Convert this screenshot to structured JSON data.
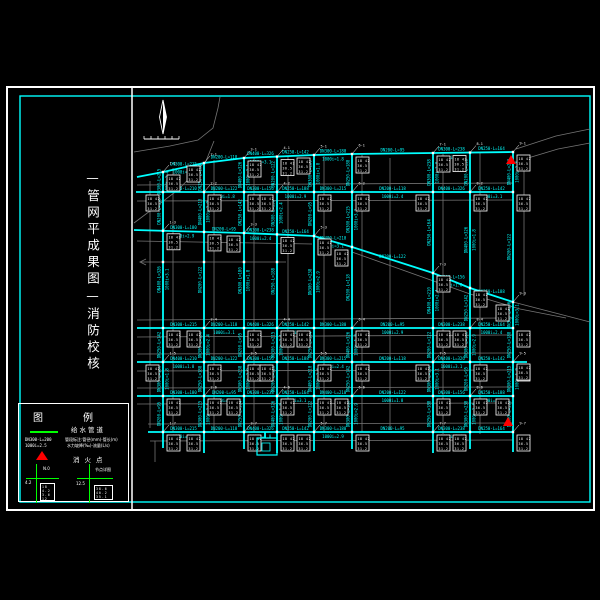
{
  "colors": {
    "background": "#000000",
    "frame": "#ffffff",
    "inner_frame": "#00ffff",
    "pipe": "#00ffff",
    "road": "#757575",
    "pipe_label": "#00ffff",
    "node_label": "#ffffff",
    "legend_green": "#00ff00",
    "hydrant_red": "#ff0000"
  },
  "frame": {
    "outer": [
      7,
      87,
      587,
      423
    ],
    "inner": [
      20,
      96,
      570,
      406
    ],
    "divider_x": 132
  },
  "title_block": {
    "vertical_title": "—管网平成果图—消防校核"
  },
  "legend": {
    "title": "图例",
    "pipe_label": "给水管道",
    "pipe_sym_line1": "DN300-L=200",
    "pipe_sym_line2": "1000i=2.5",
    "pipe_note_line1": "管段标注:管径(mm)-管长(m)",
    "pipe_note_line2": "水力坡降(‰)-流量(L/s)",
    "hydrant_label": "消火点",
    "node_left_label": "N.0",
    "node_left_sub": "4.2",
    "node_right_label": "节点详图",
    "node_right_sub": "12.5",
    "legend_table_left": [
      "18",
      "4.2",
      "3.6",
      "12"
    ],
    "legend_table_right": [
      "38.6",
      "40.2",
      "35.1"
    ]
  },
  "network": {
    "columns": [
      163,
      204,
      244,
      277,
      314,
      352,
      433,
      470,
      513
    ],
    "col_top_y": [
      172,
      163,
      158,
      156,
      155,
      154,
      153,
      152,
      152
    ],
    "col_bottom_y": [
      448,
      453,
      449,
      453,
      451,
      449,
      453,
      449,
      452
    ],
    "flat_rows": [
      [
        136,
        192,
        513,
        192
      ],
      [
        137,
        328,
        513,
        328
      ],
      [
        137,
        362,
        527,
        362
      ],
      [
        137,
        396,
        513,
        396
      ],
      [
        148,
        432,
        513,
        432
      ]
    ],
    "top_row": [
      [
        137,
        177
      ],
      [
        163,
        172
      ],
      [
        204,
        163
      ],
      [
        244,
        158
      ],
      [
        314,
        155
      ],
      [
        352,
        154
      ],
      [
        433,
        153
      ],
      [
        513,
        152
      ]
    ],
    "mid_row": [
      [
        134,
        230
      ],
      [
        244,
        233
      ],
      [
        314,
        236
      ],
      [
        352,
        247
      ],
      [
        433,
        273
      ],
      [
        470,
        288
      ],
      [
        513,
        302
      ]
    ],
    "roads": [
      [
        [
          134,
          152
        ],
        [
          170,
          146
        ],
        [
          198,
          140
        ],
        [
          213,
          128
        ],
        [
          218,
          108
        ],
        [
          220,
          97
        ]
      ],
      [
        [
          134,
          223
        ],
        [
          178,
          190
        ],
        [
          206,
          161
        ],
        [
          214,
          141
        ]
      ],
      [
        [
          140,
          262
        ],
        [
          286,
          262
        ]
      ],
      [
        [
          146,
          259
        ],
        [
          140,
          262
        ],
        [
          146,
          265
        ]
      ],
      [
        [
          150,
          181
        ],
        [
          150,
          428
        ]
      ],
      [
        [
          173,
          168
        ],
        [
          173,
          432
        ]
      ],
      [
        [
          214,
          160
        ],
        [
          214,
          432
        ]
      ],
      [
        [
          254,
          158
        ],
        [
          254,
          432
        ]
      ],
      [
        [
          288,
          157
        ],
        [
          288,
          432
        ]
      ],
      [
        [
          324,
          156
        ],
        [
          324,
          432
        ]
      ],
      [
        [
          362,
          155
        ],
        [
          362,
          432
        ]
      ],
      [
        [
          390,
          158
        ],
        [
          390,
          430
        ]
      ],
      [
        [
          443,
          154
        ],
        [
          443,
          434
        ]
      ],
      [
        [
          480,
          153
        ],
        [
          480,
          434
        ]
      ],
      [
        [
          524,
          158
        ],
        [
          524,
          296
        ]
      ],
      [
        [
          137,
          185
        ],
        [
          513,
          183
        ]
      ],
      [
        [
          137,
          201
        ],
        [
          513,
          200
        ]
      ],
      [
        [
          137,
          241
        ],
        [
          312,
          244
        ]
      ],
      [
        [
          137,
          320
        ],
        [
          513,
          318
        ]
      ],
      [
        [
          137,
          337
        ],
        [
          513,
          335
        ]
      ],
      [
        [
          137,
          354
        ],
        [
          513,
          353
        ]
      ],
      [
        [
          137,
          371
        ],
        [
          513,
          370
        ]
      ],
      [
        [
          137,
          388
        ],
        [
          513,
          387
        ]
      ],
      [
        [
          137,
          404
        ],
        [
          513,
          403
        ]
      ],
      [
        [
          148,
          424
        ],
        [
          513,
          423
        ]
      ],
      [
        [
          150,
          441
        ],
        [
          513,
          440
        ]
      ],
      [
        [
          155,
          441
        ],
        [
          155,
          462
        ]
      ],
      [
        [
          513,
          302
        ],
        [
          590,
          322
        ]
      ],
      [
        [
          352,
          252
        ],
        [
          470,
          294
        ],
        [
          520,
          309
        ],
        [
          566,
          318
        ]
      ],
      [
        [
          516,
          149
        ],
        [
          556,
          136
        ],
        [
          590,
          129
        ]
      ],
      [
        [
          518,
          161
        ],
        [
          558,
          149
        ],
        [
          590,
          143
        ]
      ]
    ],
    "road_cross_nodes": [
      [
        163,
        262
      ],
      [
        204,
        262
      ],
      [
        244,
        262
      ],
      [
        277,
        262
      ]
    ],
    "hydrants": [
      [
        511,
        161
      ],
      [
        508,
        423
      ]
    ],
    "special_box": [
      257,
      438,
      20,
      17
    ],
    "special_box_inner": [
      262,
      443,
      8,
      8
    ],
    "special_box_stub": [
      265,
      432,
      265,
      438
    ],
    "extra_boxes": [
      [
        517,
        364
      ]
    ],
    "compass": {
      "x": 163,
      "y1": 100,
      "y2": 134
    },
    "scalebar": {
      "x1": 144,
      "x2": 179,
      "y": 139,
      "ticks": 6
    },
    "label_pool": [
      "DN300-L=215",
      "DN200-L=118",
      "DN400-L=326",
      "DN250-L=142",
      "DN300-L=180",
      "DN200-L=95",
      "DN300-L=238",
      "DN250-L=164",
      "DN400-L=210",
      "DN200-L=122",
      "DN300-L=156",
      "DN250-L=188"
    ],
    "sub_pool": [
      "1000i=2.4",
      "q=36.5",
      "1000i=3.1",
      "q=18.2",
      "1000i=1.8",
      "q=42.0",
      "1000i=2.9",
      "q=25.4"
    ],
    "node_box_rows": [
      "18 42",
      "36.5",
      "31.2"
    ]
  }
}
